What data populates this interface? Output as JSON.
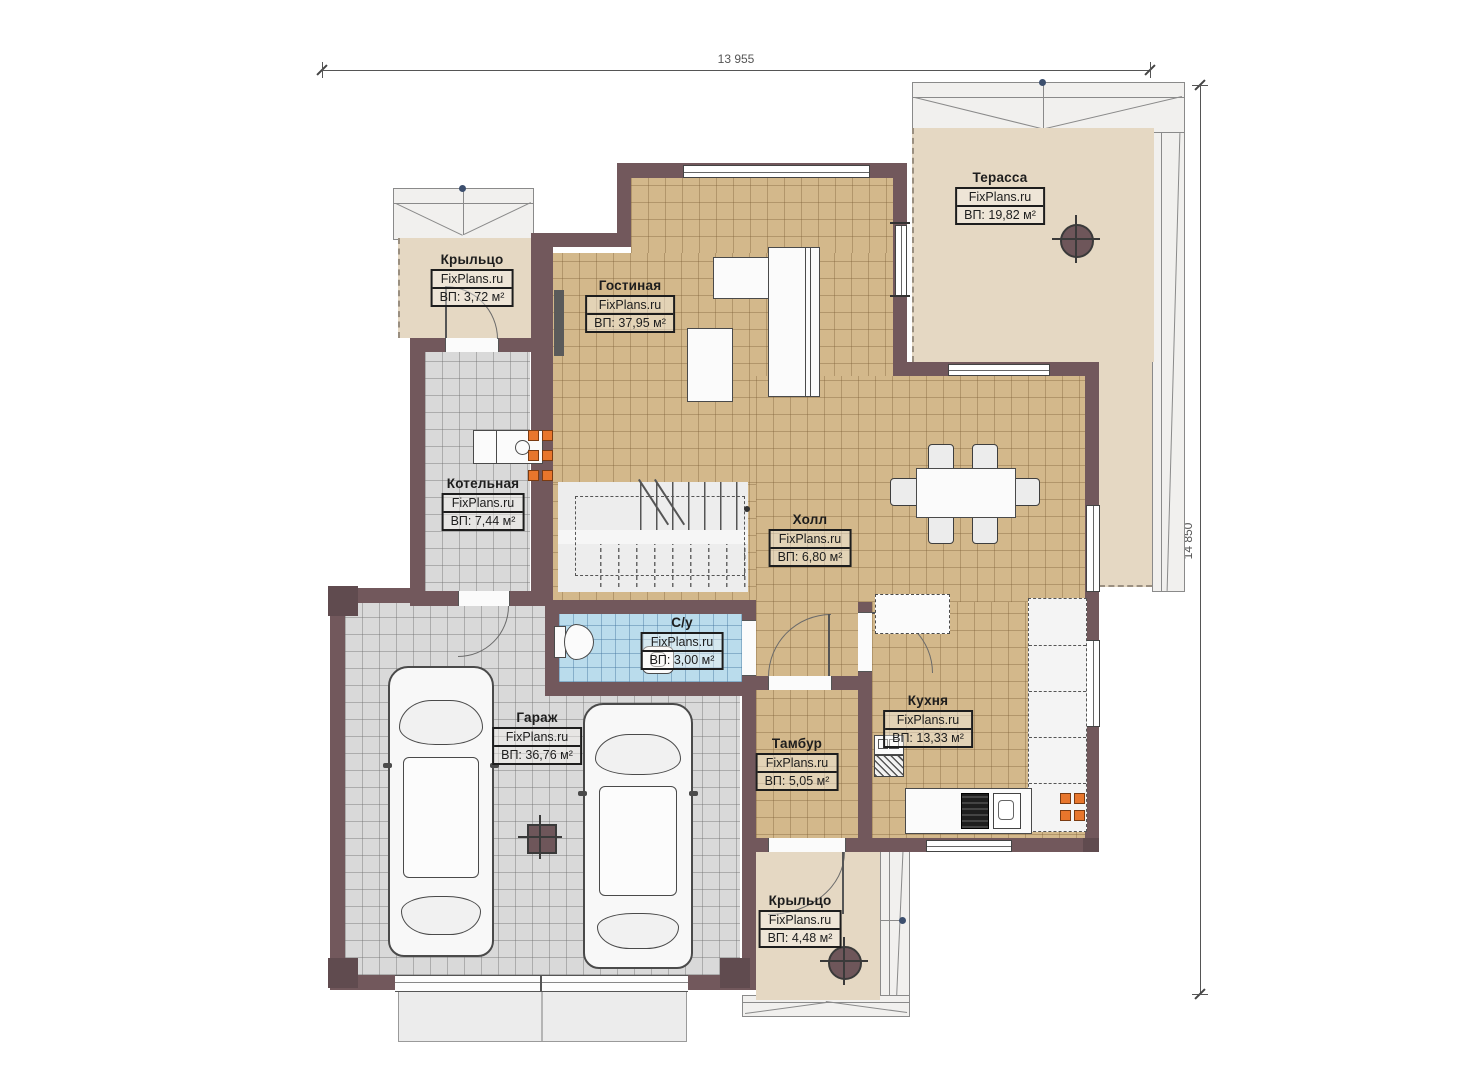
{
  "watermark": "FixPlans.ru",
  "dimensions": {
    "top": "13 955",
    "right": "14 850"
  },
  "rooms": [
    {
      "name": "Терасса",
      "area": "ВП: 19,82 м²"
    },
    {
      "name": "Крыльцо",
      "area": "ВП: 3,72 м²"
    },
    {
      "name": "Гостиная",
      "area": "ВП: 37,95 м²"
    },
    {
      "name": "Котельная",
      "area": "ВП: 7,44 м²"
    },
    {
      "name": "Холл",
      "area": "ВП: 6,80 м²"
    },
    {
      "name": "С/у",
      "area": "ВП: 3,00 м²"
    },
    {
      "name": "Гараж",
      "area": "ВП: 36,76 м²"
    },
    {
      "name": "Тамбур",
      "area": "ВП: 5,05 м²"
    },
    {
      "name": "Кухня",
      "area": "ВП: 13,33 м²"
    },
    {
      "name": "Крыльцо",
      "area": "ВП: 4,48 м²"
    }
  ],
  "colors": {
    "wall": "#72585c",
    "floor_tan": "#d3b88b",
    "floor_gray": "#d9d9d9",
    "floor_beige": "#e5d8c3",
    "floor_blue": "#badcec",
    "radiator": "#e8762c"
  }
}
